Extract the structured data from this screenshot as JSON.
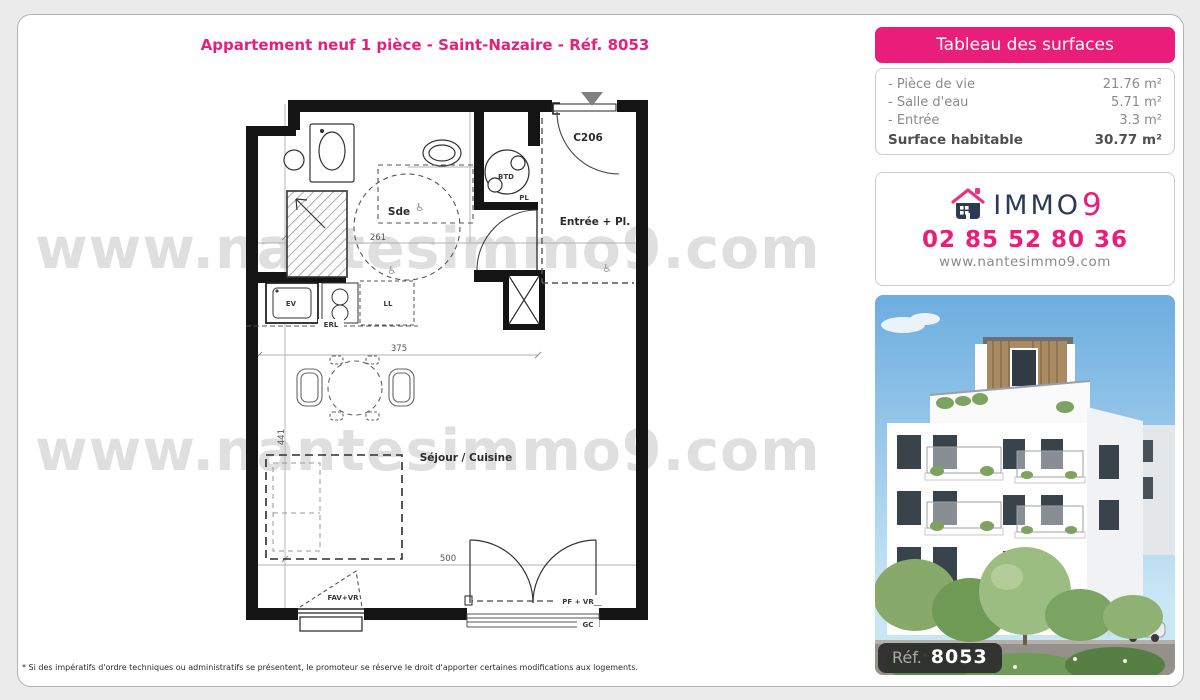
{
  "page": {
    "title": "Appartement neuf 1 pièce - Saint-Nazaire - Réf. 8053",
    "watermark": "www.nantesimmo9.com",
    "footnote": "* Si des impératifs d'ordre techniques ou administratifs se présentent, le promoteur se réserve le droit d'apporter certaines modifications aux logements."
  },
  "surfaces": {
    "header": "Tableau des surfaces",
    "rows": [
      {
        "label": "- Pièce de vie",
        "value": "21.76 m²"
      },
      {
        "label": "- Salle d'eau",
        "value": "5.71 m²"
      },
      {
        "label": "- Entrée",
        "value": "3.3 m²"
      }
    ],
    "total_label": "Surface habitable",
    "total_value": "30.77 m²"
  },
  "agency": {
    "brand": "IMMO",
    "brand_digit": "9",
    "phone": "02 85 52 80 36",
    "website": "www.nantesimmo9.com"
  },
  "photo": {
    "ref_label": "Réf.",
    "ref_number": "8053"
  },
  "plan": {
    "unit": "C206",
    "rooms": {
      "sde": "Sde",
      "entree": "Entrée + Pl.",
      "sejour": "Séjour / Cuisine"
    },
    "fixtures": {
      "btd": "BTD",
      "pl": "PL",
      "ev": "EV",
      "erl": "ERL",
      "ll": "LL",
      "fav": "FAV+VR",
      "pf": "PF + VR",
      "gc": "GC"
    },
    "dims": {
      "d261": "261",
      "d375": "375",
      "d441": "441",
      "d500": "500"
    }
  },
  "colors": {
    "accent": "#e91e7b",
    "navy": "#2b3a55"
  }
}
